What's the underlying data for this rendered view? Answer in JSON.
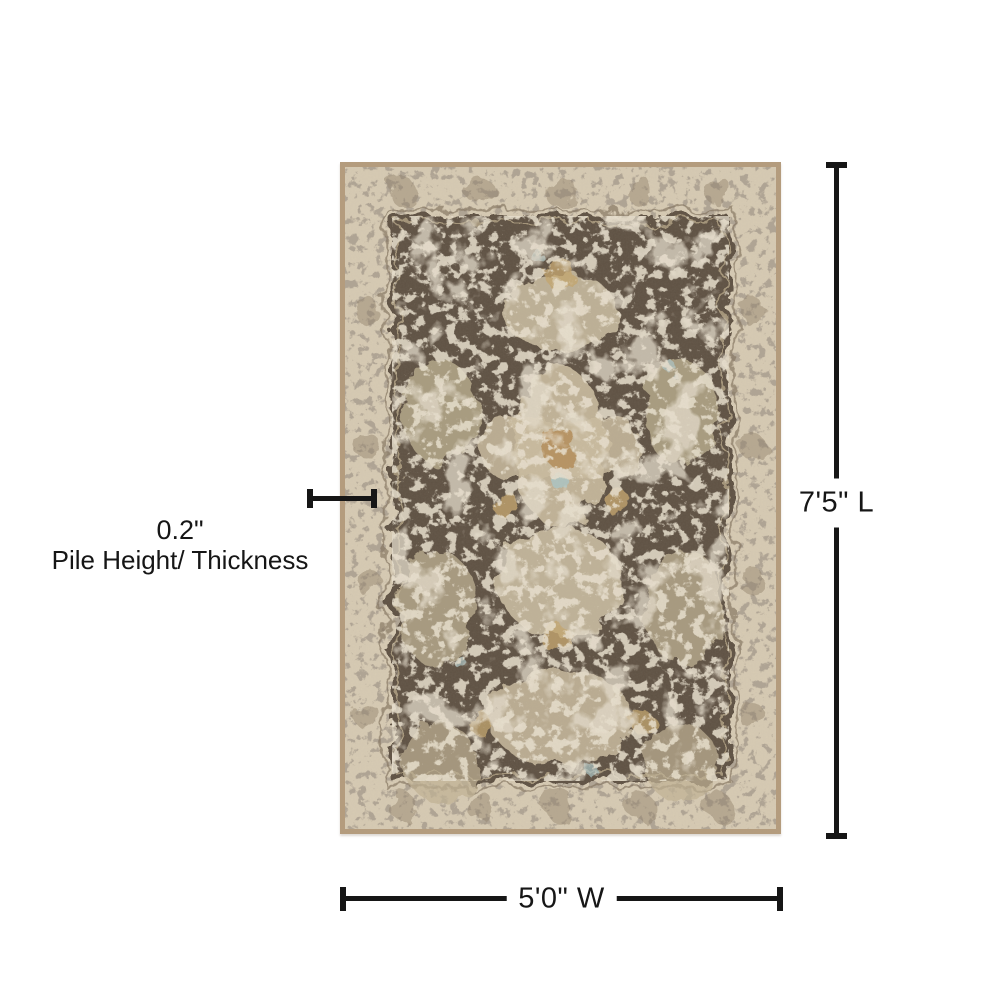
{
  "diagram": {
    "length_label": "7'5\" L",
    "width_label": "5'0\" W",
    "pile_value": "0.2\"",
    "pile_description": "Pile Height/ Thickness",
    "line_color": "#161616",
    "text_color": "#161616",
    "background_color": "#ffffff"
  },
  "rug": {
    "description": "distressed vintage oriental area rug, brown field with cream medallions",
    "colors": {
      "binding_tan": "#b19878",
      "border_cream": "#d6cab2",
      "field_brown": "#57493a",
      "motif_cream": "#ccbfa2",
      "accent_gold": "#c2a368",
      "accent_blue": "#a9c6c8"
    }
  }
}
